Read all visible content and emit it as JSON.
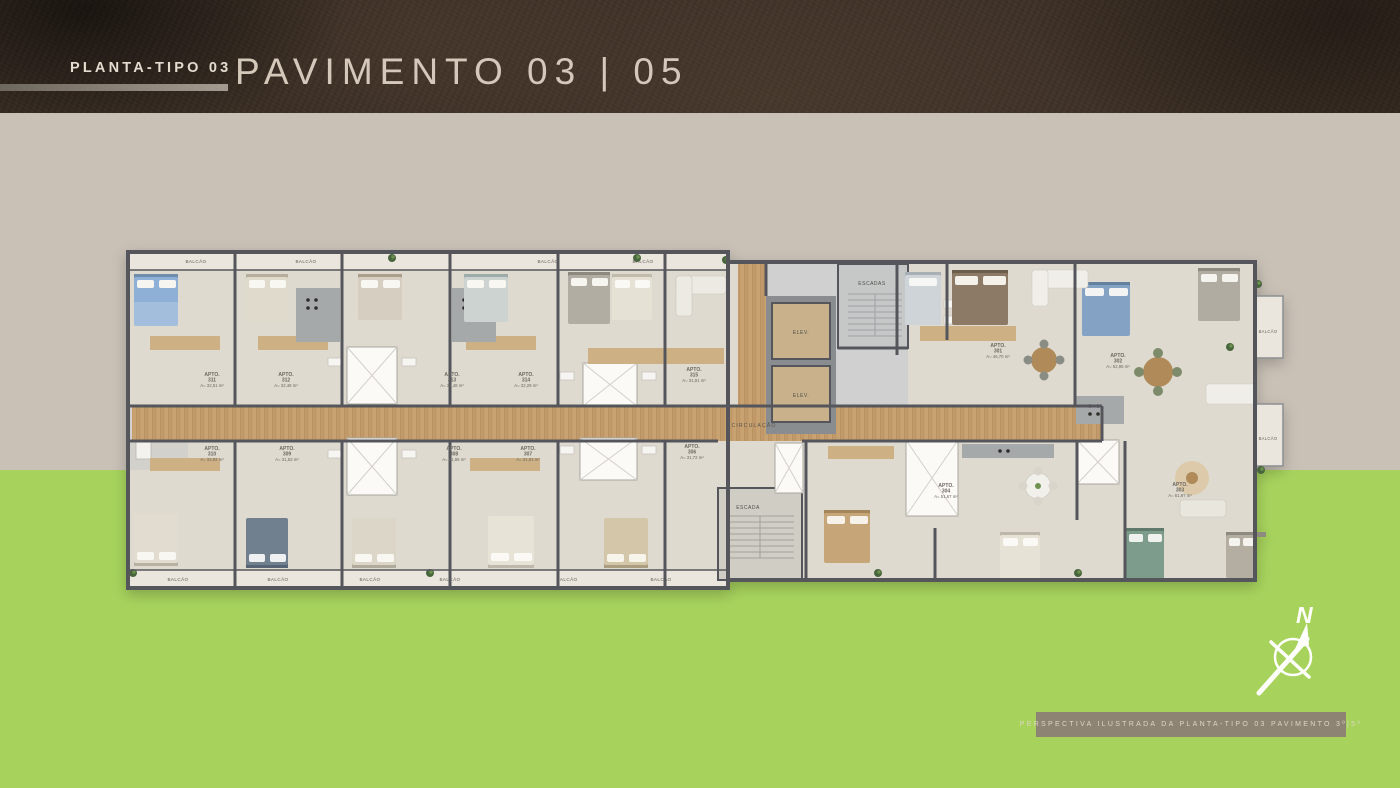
{
  "header": {
    "kicker": "PLANTA-TIPO 03",
    "title": "PAVIMENTO 03 | 05"
  },
  "footer": {
    "caption": "PERSPECTIVA ILUSTRADA DA PLANTA-TIPO 03 PAVIMENTO 3º|5º"
  },
  "compass": {
    "north": "N"
  },
  "colors": {
    "header_bg": "#3c3026",
    "page_bg": "#c9c1b6",
    "grass": "#a7d35d",
    "wall": "#54575b",
    "corridor_wood": "#c9a271",
    "title_text": "#d3c8ba"
  },
  "floorplan": {
    "labels": {
      "circulation": "CIRCULAÇÃO",
      "stairs_upper": "ESCADAS",
      "stairs_lower": "ESCADA",
      "elevator": "ELEV.",
      "balcony": "BALCÃO"
    },
    "apartments": [
      {
        "label": "APTO.",
        "number": "311",
        "area": "A= 32,51 m²"
      },
      {
        "label": "APTO.",
        "number": "312",
        "area": "A= 32,48 m²"
      },
      {
        "label": "APTO.",
        "number": "313",
        "area": "A= 32,48 m²"
      },
      {
        "label": "APTO.",
        "number": "314",
        "area": "A= 32,29 m²"
      },
      {
        "label": "APTO.",
        "number": "315",
        "area": "A= 31,91 m²"
      },
      {
        "label": "APTO.",
        "number": "310",
        "area": "A= 32,92 m²"
      },
      {
        "label": "APTO.",
        "number": "309",
        "area": "A= 31,53 m²"
      },
      {
        "label": "APTO.",
        "number": "308",
        "area": "A= 31,86 m²"
      },
      {
        "label": "APTO.",
        "number": "307",
        "area": "A= 31,91 m²"
      },
      {
        "label": "APTO.",
        "number": "306",
        "area": "A= 31,72 m²"
      },
      {
        "label": "APTO.",
        "number": "301",
        "area": "A= 46,70 m²"
      },
      {
        "label": "APTO.",
        "number": "302",
        "area": "A= 52,95 m²"
      },
      {
        "label": "APTO.",
        "number": "303",
        "area": "A= 61,97 m²"
      },
      {
        "label": "APTO.",
        "number": "304",
        "area": "A= 51,67 m²"
      }
    ]
  }
}
